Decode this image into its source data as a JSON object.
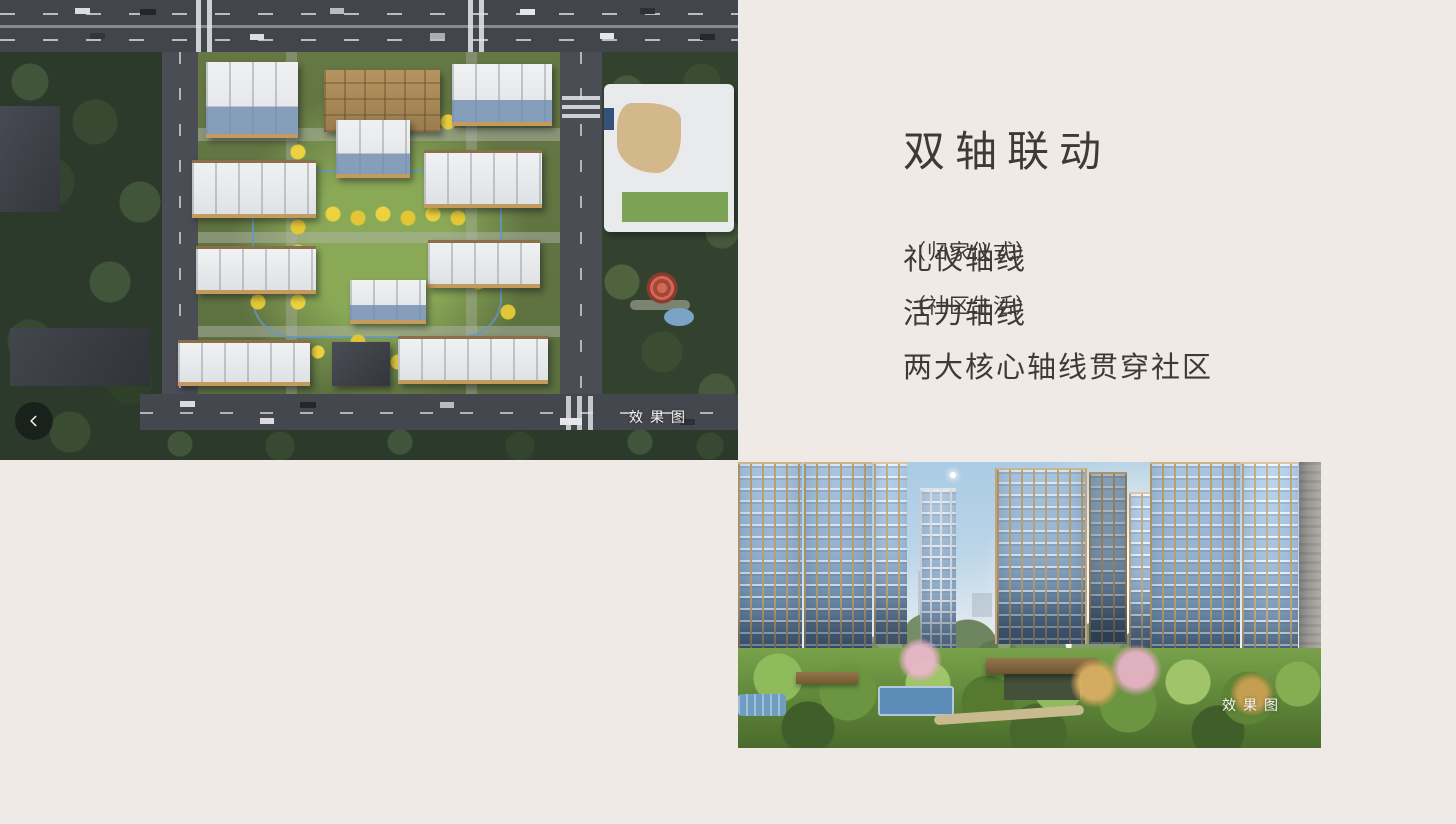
{
  "page": {
    "background_color": "#efeae6",
    "text_color": "#3f3a36",
    "watermark_color": "#f5f5f2"
  },
  "content": {
    "title": "双轴联动",
    "lines": [
      {
        "main": "礼仪轴线",
        "note": "（归家仪式）"
      },
      {
        "main": "活力轴线",
        "note": "（社区生活）"
      },
      {
        "main": "两大核心轴线贯穿社区",
        "note": ""
      }
    ]
  },
  "carousel": {
    "prev_icon": "chevron-left-icon"
  },
  "images": {
    "aerial_rendering": {
      "watermark_label": "效果图"
    },
    "courtyard_rendering": {
      "watermark_label": "效果图"
    }
  }
}
